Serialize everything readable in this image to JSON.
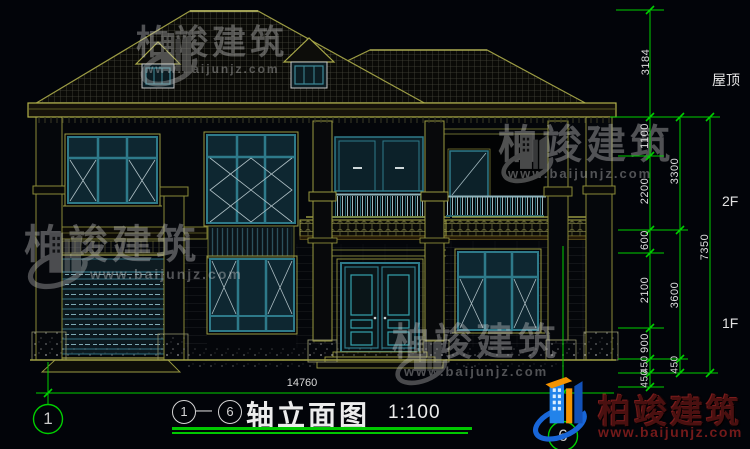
{
  "drawing": {
    "title": "轴立面图",
    "scale": "1:100",
    "separator": "—"
  },
  "floor_labels": {
    "roof": "屋顶",
    "f2": "2F",
    "f1": "1F"
  },
  "dims": {
    "v3184": "3184",
    "v1100": "1100",
    "v2200": "2200",
    "v600": "600",
    "v2100": "2100",
    "v900": "900",
    "v450a": "450",
    "v450b": "450",
    "v3300": "3300",
    "v3600": "3600",
    "v450c": "450",
    "v7350": "7350",
    "width": "14760"
  },
  "axis": {
    "left": "1",
    "right": "6"
  },
  "watermark": {
    "brand": "柏竣建筑",
    "url": "www.baijunjz.com"
  },
  "logo": {
    "brand": "柏竣建筑",
    "url": "www.baijunjz.com"
  },
  "colors": {
    "dim_green": "#00cf00",
    "cad_yellow": "#9a9a42",
    "frame_teal": "#2e7a8a",
    "logo_blue": "#1e7ce8",
    "logo_orange": "#f59300"
  }
}
